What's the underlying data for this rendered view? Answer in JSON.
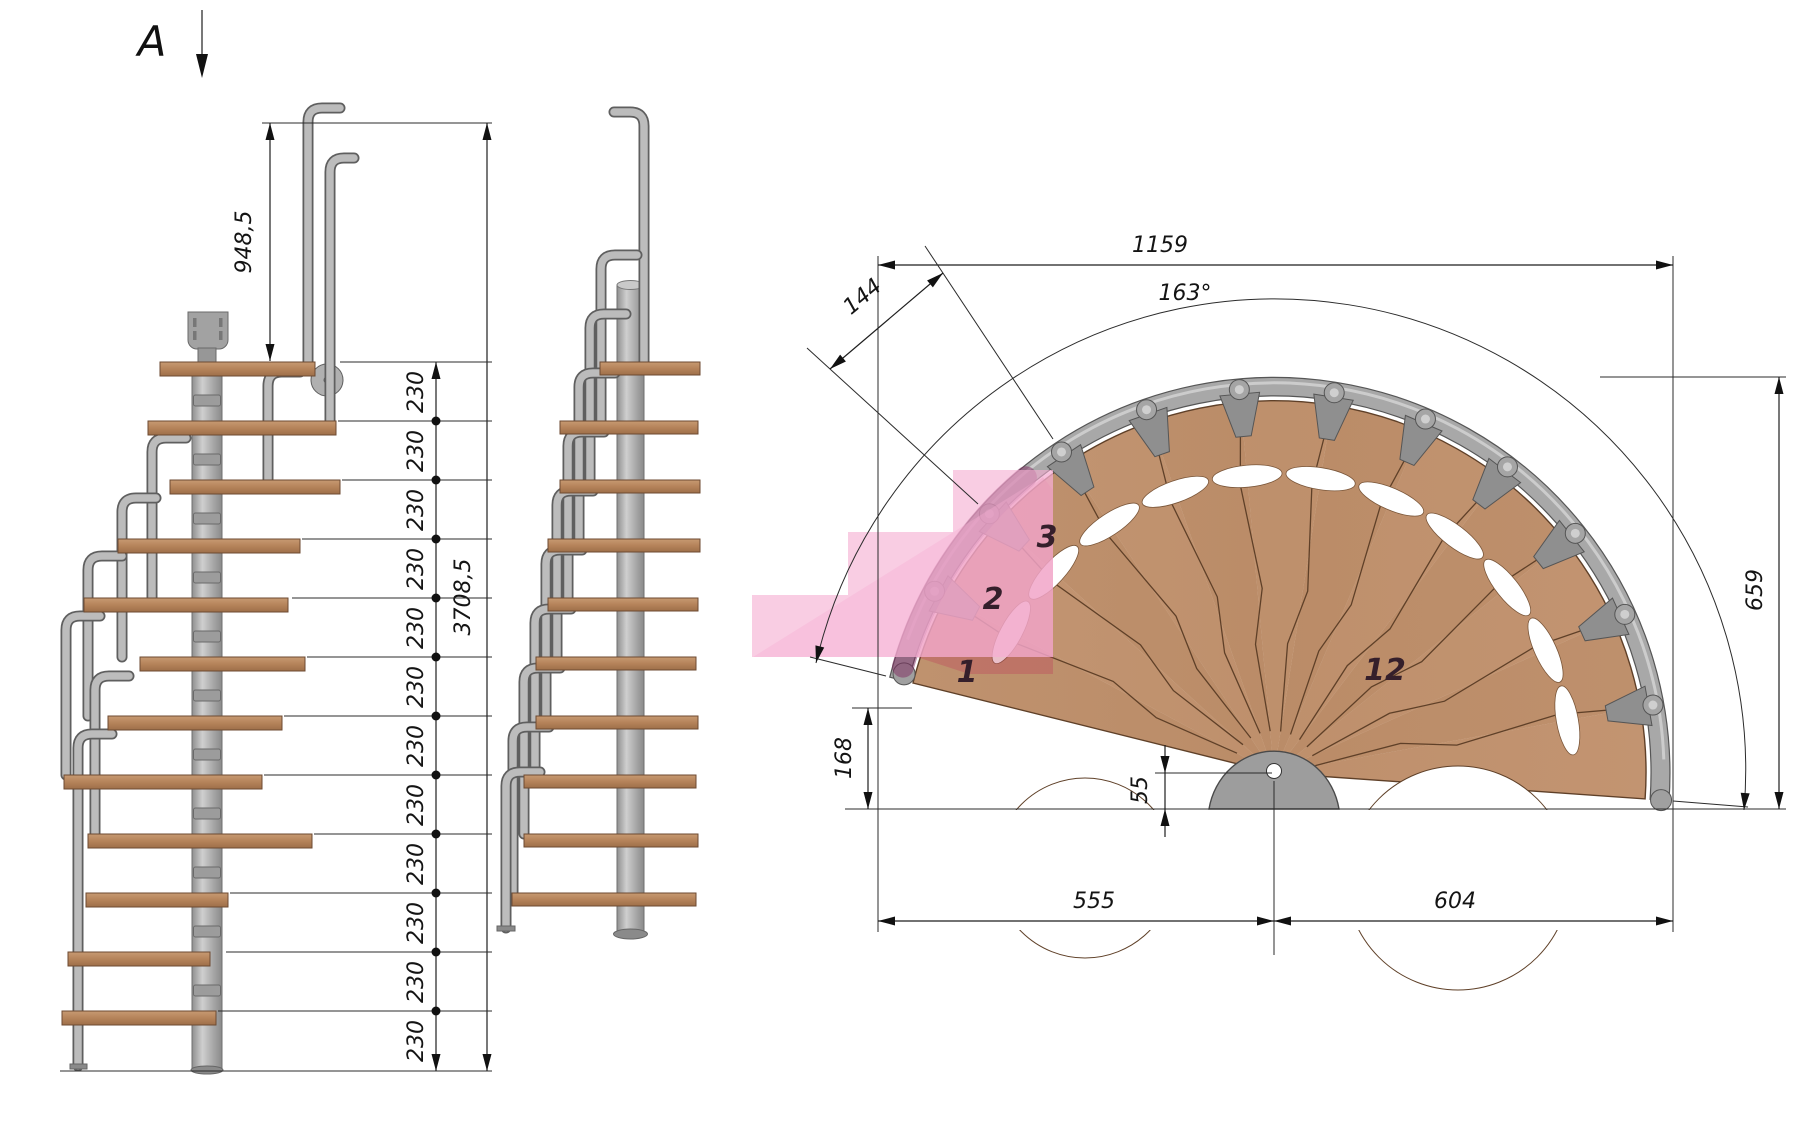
{
  "section_marker": {
    "label": "A"
  },
  "side_view": {
    "top_riser_height": "948,5",
    "total_height": "3708,5",
    "rise_labels": [
      "230",
      "230",
      "230",
      "230",
      "230",
      "230",
      "230",
      "230",
      "230",
      "230",
      "230",
      "230"
    ]
  },
  "plan_view": {
    "overall_width": "1159",
    "sweep_angle": "163°",
    "tread_outer_width": "144",
    "overall_depth": "659",
    "entry_height": "168",
    "pole_center_offset": "55",
    "left_span": "555",
    "right_span": "604",
    "tread_numbers": {
      "first": "1",
      "second": "2",
      "third": "3",
      "last": "12"
    }
  },
  "colors": {
    "wood": "#c0936e",
    "wood_edge": "#5f4028",
    "steel": "#ababab",
    "steel_dark": "#5f5f5f",
    "highlight_pink": "#f6aed2",
    "highlight_rose": "#c04c68",
    "line": "#1a1a1a"
  }
}
